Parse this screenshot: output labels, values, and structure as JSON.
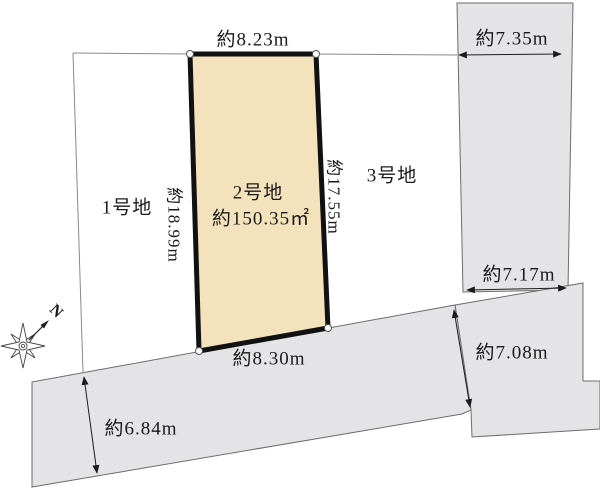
{
  "lots": {
    "lot1_label": "1号地",
    "lot2_label": "2号地",
    "lot2_area": "約150.35㎡",
    "lot3_label": "3号地"
  },
  "dimensions": {
    "lot2_top": "約8.23m",
    "lot2_left": "約18.99m",
    "lot2_right": "約17.55m",
    "lot2_bottom": "約8.30m",
    "east_parcel_width_top": "約7.35m",
    "east_parcel_width_bottom": "約7.17m",
    "road_width_east": "約7.08m",
    "road_width_west": "約6.84m"
  },
  "compass": {
    "north_label": "N"
  },
  "colors": {
    "lot2_fill": "#f4e2bd",
    "neighbor_fill": "#e4e4e6",
    "lot2_border": "#111111"
  }
}
